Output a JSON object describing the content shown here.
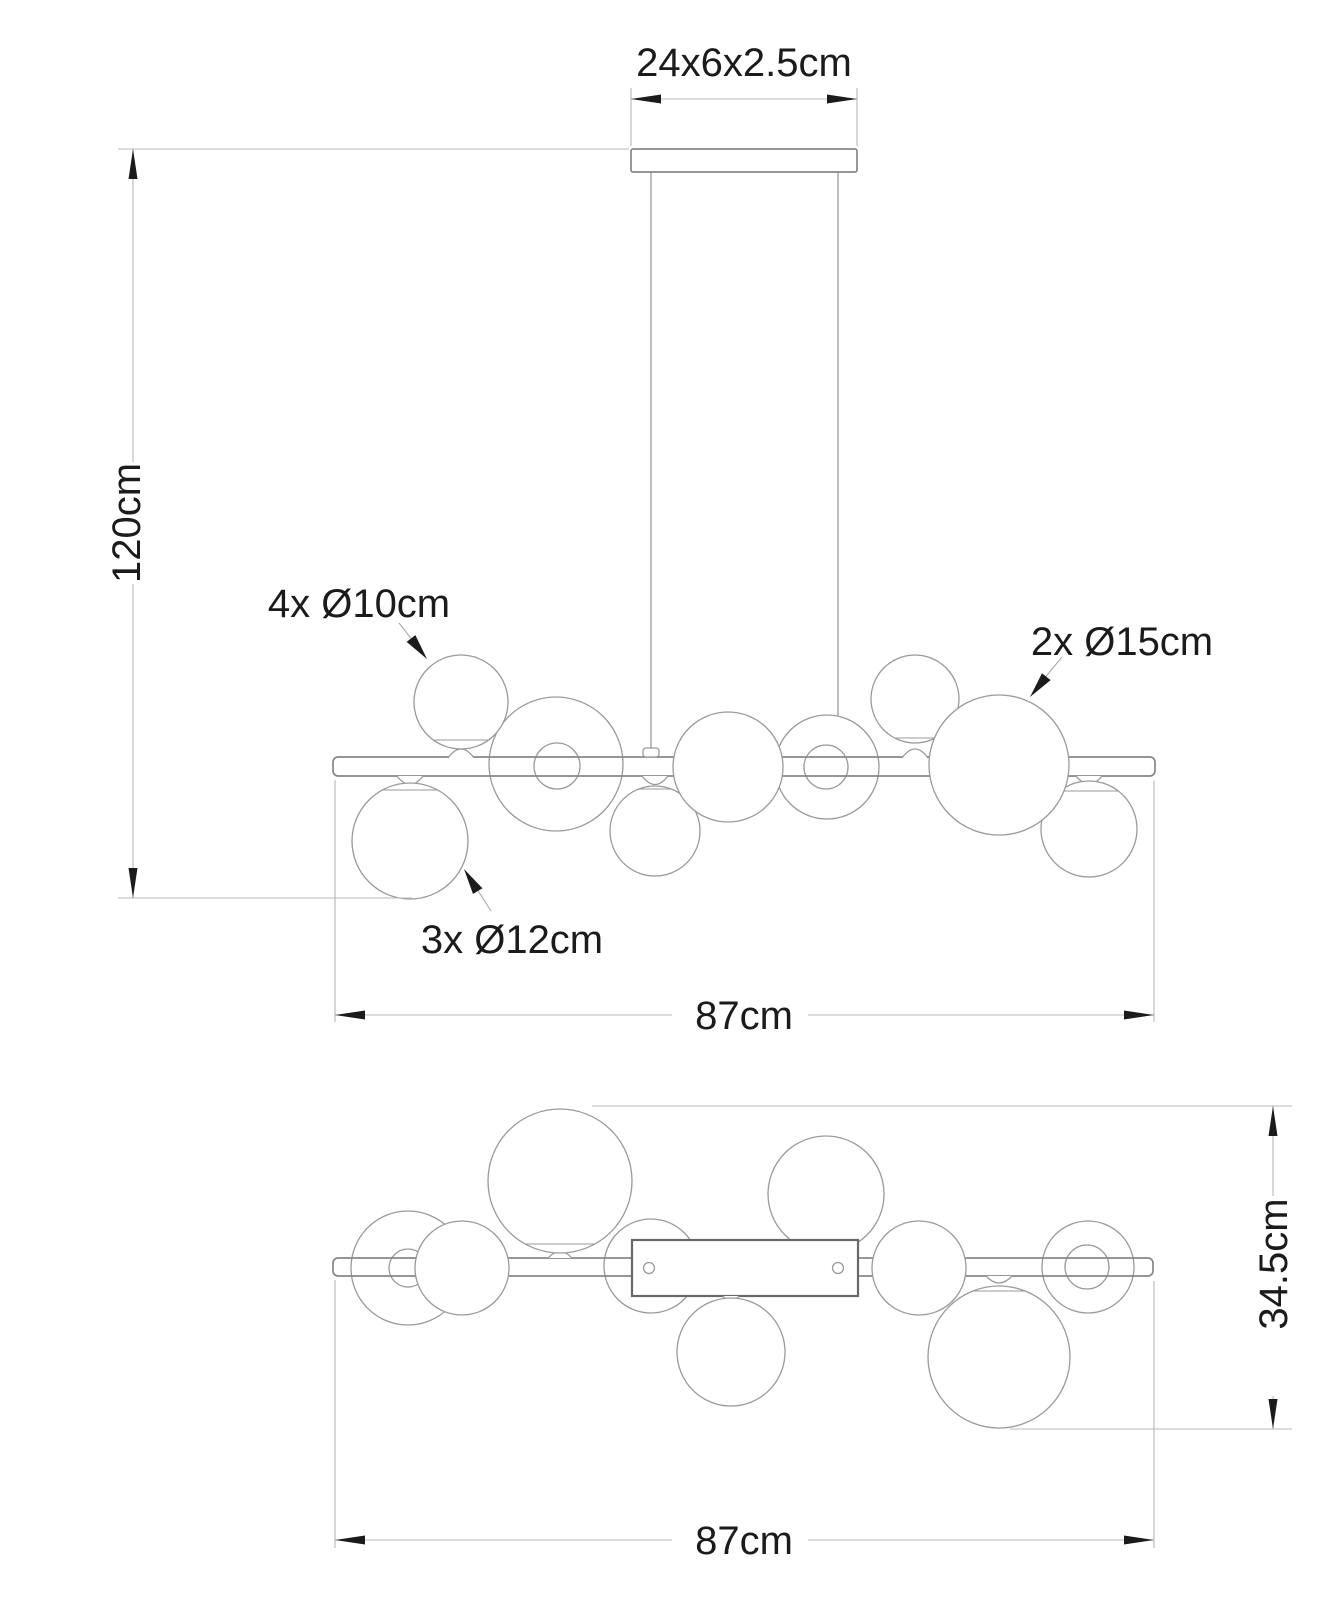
{
  "drawing": {
    "product": "bubble pendant lamp dimension drawing",
    "labels": {
      "canopy_size": "24x6x2.5cm",
      "drop_height": "120cm",
      "spheres_small": "4x Ø10cm",
      "spheres_large": "2x Ø15cm",
      "spheres_medium": "3x Ø12cm",
      "width_front_view": "87cm",
      "width_top_view": "87cm",
      "depth_top_view": "34.5cm"
    },
    "dimensions": [
      {
        "name": "canopy",
        "value": "24x6x2.5",
        "unit": "cm"
      },
      {
        "name": "max drop height",
        "value": "120",
        "unit": "cm"
      },
      {
        "name": "fixture width",
        "value": "87",
        "unit": "cm"
      },
      {
        "name": "fixture depth",
        "value": "34.5",
        "unit": "cm"
      },
      {
        "name": "glass spheres 10cm",
        "count": 4,
        "diameter_cm": 10
      },
      {
        "name": "glass spheres 12cm",
        "count": 3,
        "diameter_cm": 12
      },
      {
        "name": "glass spheres 15cm",
        "count": 2,
        "diameter_cm": 15
      }
    ],
    "colors": {
      "background": "#ffffff",
      "outline": "#9a9a9a",
      "frame_outline": "#878787",
      "mount_box_outline": "#686868",
      "dimension_line": "#b8b8b8",
      "ink": "#1b1b1b"
    }
  }
}
